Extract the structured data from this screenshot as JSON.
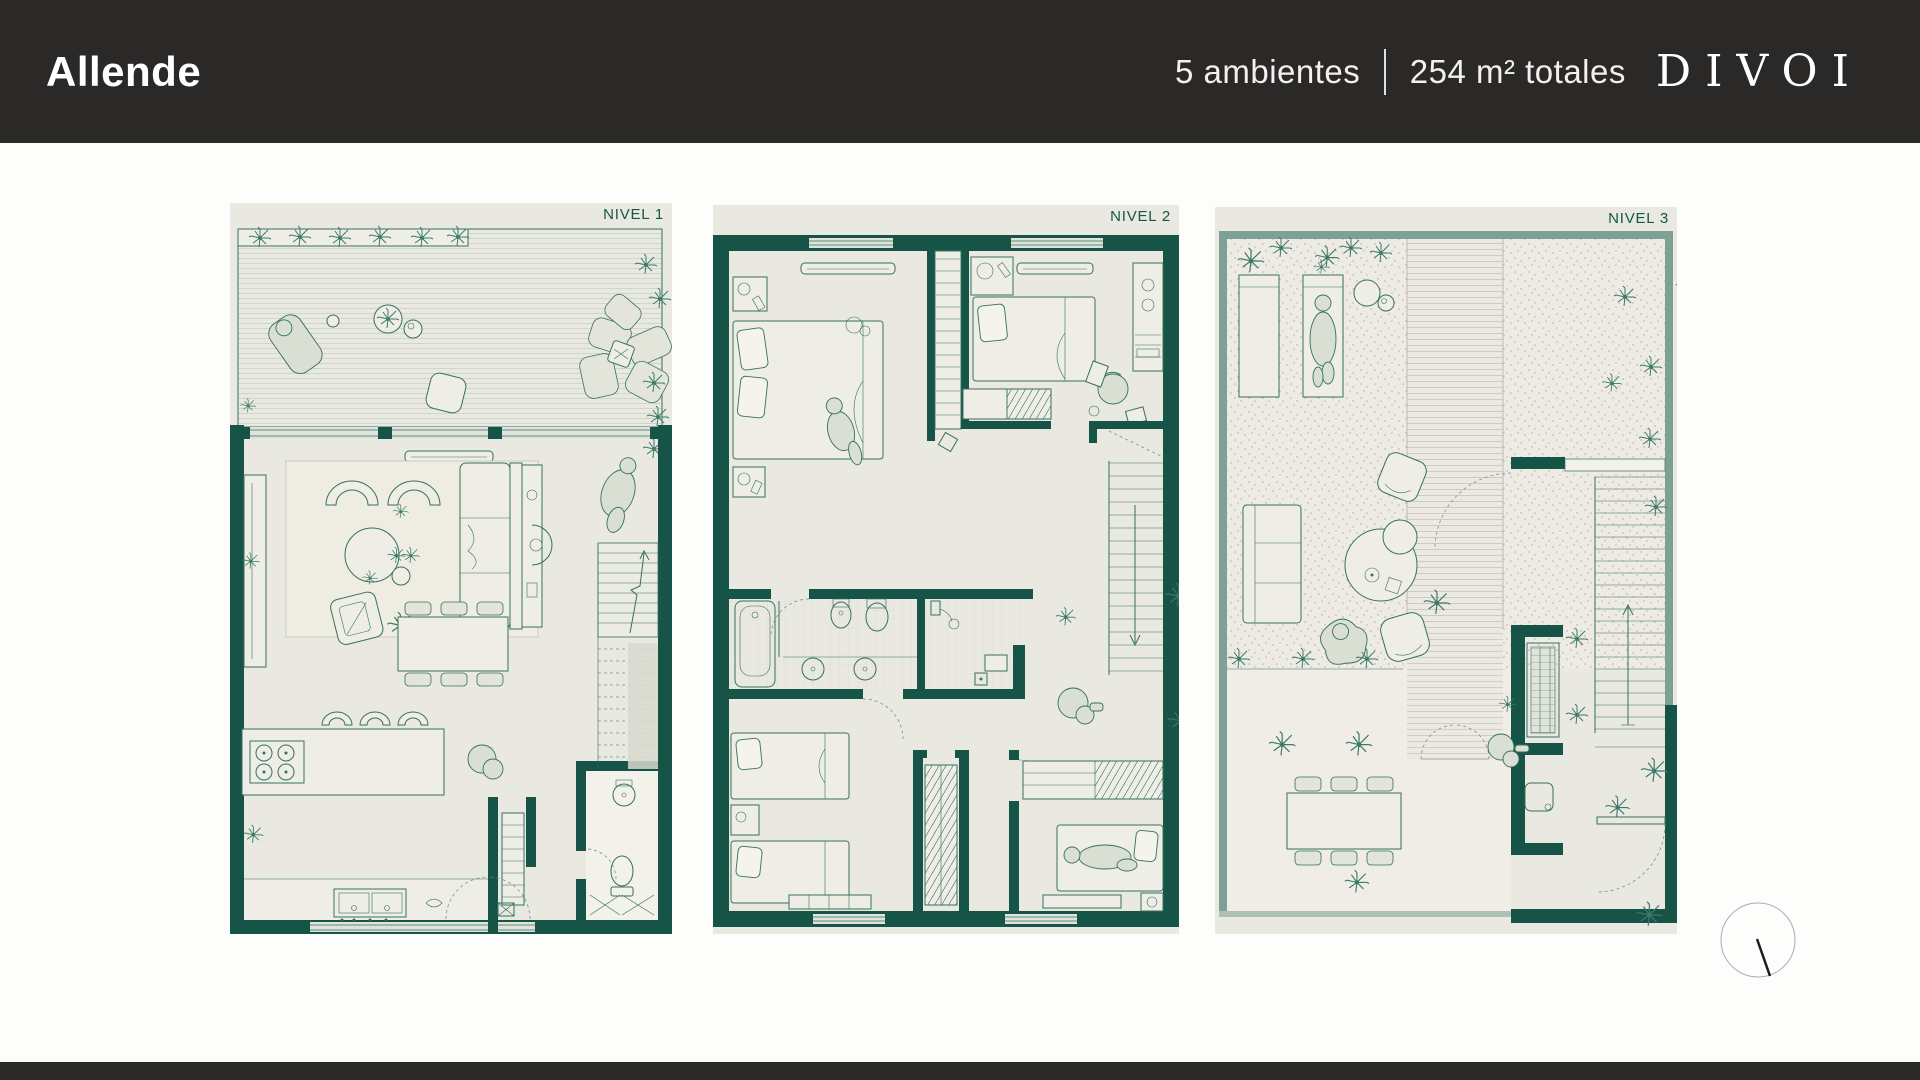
{
  "header": {
    "title": "Allende",
    "rooms_label": "5 ambientes",
    "area_label": "254 m² totales",
    "brand": "DIVOI"
  },
  "plans": [
    {
      "label": "NIVEL 1"
    },
    {
      "label": "NIVEL 2"
    },
    {
      "label": "NIVEL 3"
    }
  ],
  "colors": {
    "header_bg": "#2B2928",
    "header_text": "#FFFFFF",
    "wall_teal": "#165447",
    "furniture_line": "#35705F",
    "plan_bg": "#E9E8E1",
    "sage_wall": "#7FA195",
    "level_label_text": "#14574A",
    "footer_bg": "#2B2928",
    "page_bg": "#FFFFFF"
  },
  "icons": {
    "north_indicator": "north-indicator"
  }
}
